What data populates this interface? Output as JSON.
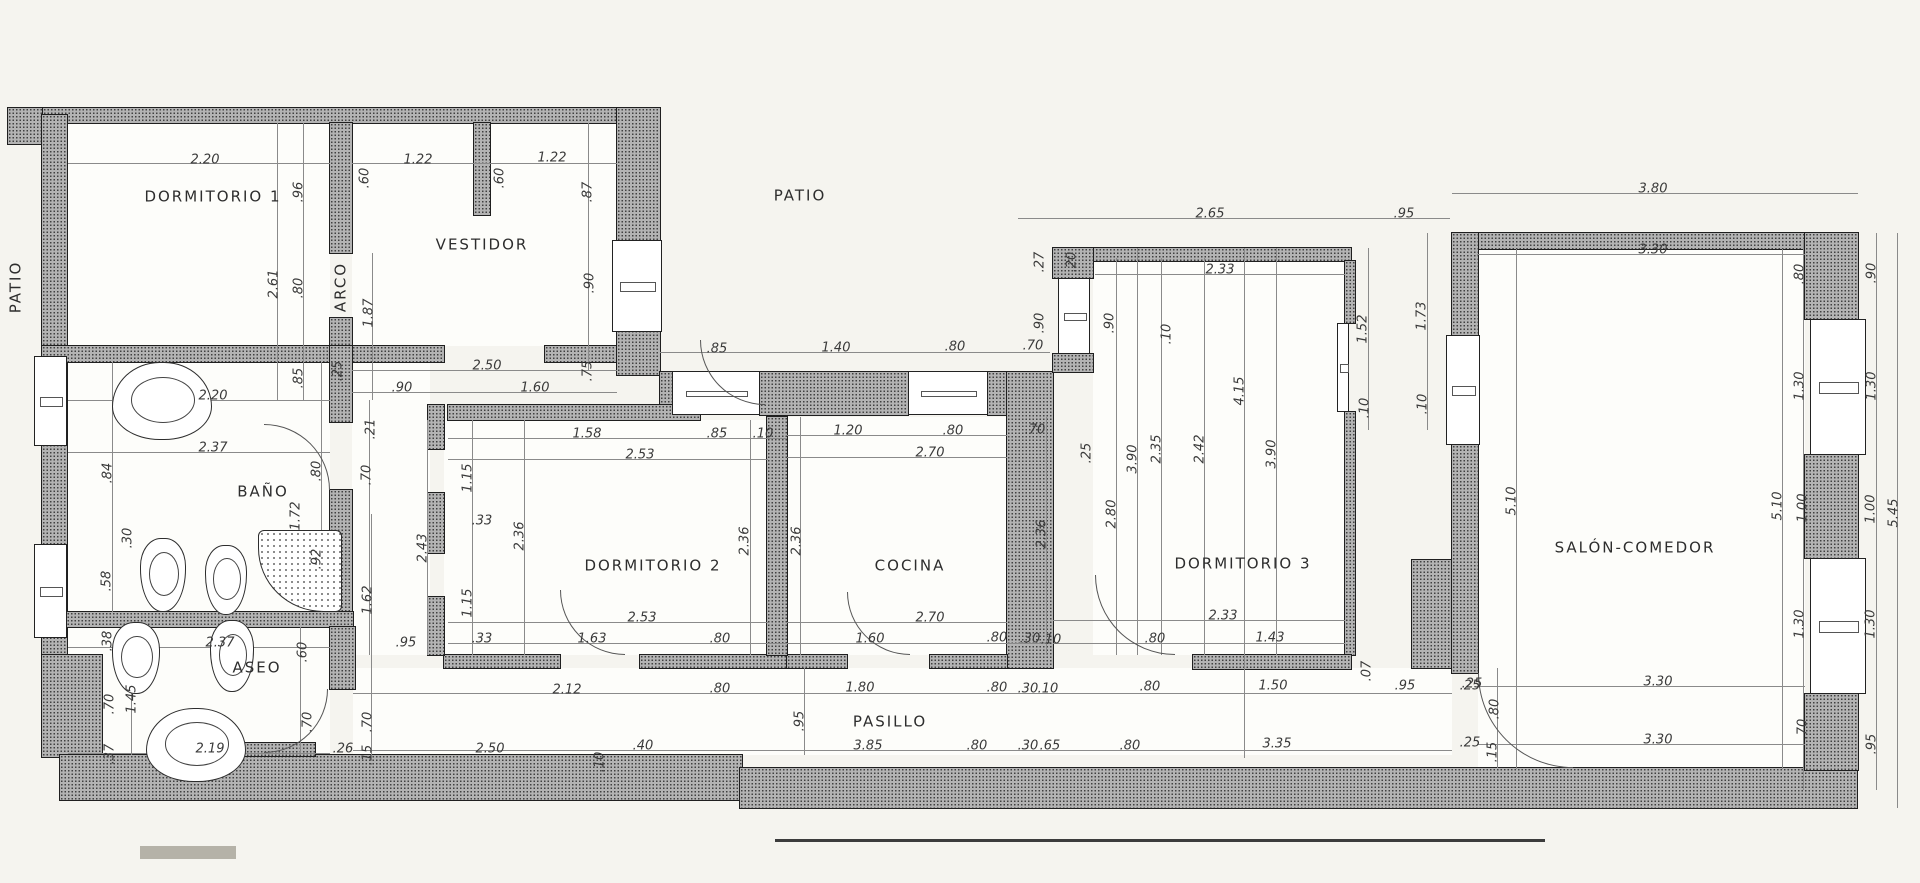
{
  "meta": {
    "type": "architectural-floor-plan",
    "language": "es",
    "units": "meters",
    "paper_color": "#f5f4ef",
    "wall_color": "#b3b3b3",
    "line_color": "#8a8a8a",
    "text_color": "#3a3a3a"
  },
  "plan": {
    "labels": [
      [
        "DORMITORIO 1",
        213,
        197,
        0
      ],
      [
        "VESTIDOR",
        482,
        245,
        0
      ],
      [
        "PATIO",
        800,
        196,
        0
      ],
      [
        "PATIO",
        16,
        287,
        1
      ],
      [
        "ARCO",
        341,
        287,
        1
      ],
      [
        "BAÑO",
        263,
        492,
        0
      ],
      [
        "ASEO",
        257,
        668,
        0
      ],
      [
        "DORMITORIO 2",
        653,
        566,
        0
      ],
      [
        "COCINA",
        910,
        566,
        0
      ],
      [
        "DORMITORIO 3",
        1243,
        564,
        0
      ],
      [
        "SALÓN-COMEDOR",
        1635,
        548,
        0
      ],
      [
        "PASILLO",
        890,
        722,
        0
      ]
    ],
    "dims": [
      [
        "2.20",
        205,
        160,
        0
      ],
      [
        "1.22",
        418,
        160,
        0
      ],
      [
        "1.22",
        552,
        158,
        0
      ],
      [
        "2.65",
        1210,
        214,
        0
      ],
      [
        ".95",
        1404,
        214,
        0
      ],
      [
        "3.80",
        1653,
        189,
        0
      ],
      [
        "3.30",
        1653,
        250,
        0
      ],
      [
        "2.33",
        1220,
        270,
        0
      ],
      [
        ".60",
        365,
        178,
        1
      ],
      [
        ".60",
        500,
        178,
        1
      ],
      [
        ".87",
        588,
        192,
        1
      ],
      [
        ".96",
        299,
        192,
        1
      ],
      [
        "2.61",
        274,
        284,
        1
      ],
      [
        ".80",
        299,
        288,
        1
      ],
      [
        "1.87",
        369,
        313,
        1
      ],
      [
        ".90",
        590,
        283,
        1
      ],
      [
        ".85",
        299,
        378,
        1
      ],
      [
        ".25",
        338,
        371,
        1
      ],
      [
        "2.20",
        213,
        396,
        0
      ],
      [
        "2.50",
        487,
        366,
        0
      ],
      [
        ".90",
        402,
        388,
        0
      ],
      [
        "1.60",
        535,
        388,
        0
      ],
      [
        ".75",
        588,
        371,
        1
      ],
      [
        ".85",
        717,
        349,
        0
      ],
      [
        "1.40",
        836,
        348,
        0
      ],
      [
        ".80",
        955,
        347,
        0
      ],
      [
        ".70",
        1033,
        346,
        0
      ],
      [
        ".27",
        1040,
        262,
        1
      ],
      [
        ".20",
        1072,
        262,
        1
      ],
      [
        ".90",
        1040,
        323,
        1
      ],
      [
        ".90",
        1110,
        323,
        1
      ],
      [
        "1.52",
        1363,
        329,
        1
      ],
      [
        "1.73",
        1422,
        316,
        1
      ],
      [
        ".10",
        1365,
        408,
        1
      ],
      [
        ".10",
        1423,
        404,
        1
      ],
      [
        ".70",
        367,
        475,
        1
      ],
      [
        ".21",
        371,
        429,
        1
      ],
      [
        "1.58",
        587,
        434,
        0
      ],
      [
        ".85",
        717,
        434,
        0
      ],
      [
        ".10",
        763,
        434,
        0
      ],
      [
        "2.53",
        640,
        455,
        0
      ],
      [
        "1.20",
        848,
        431,
        0
      ],
      [
        ".80",
        953,
        431,
        0
      ],
      [
        ".70",
        1035,
        430,
        0
      ],
      [
        "2.70",
        930,
        453,
        0
      ],
      [
        ".25",
        1087,
        453,
        1
      ],
      [
        "1.15",
        468,
        478,
        1
      ],
      [
        ".33",
        482,
        521,
        0
      ],
      [
        "2.36",
        520,
        536,
        1
      ],
      [
        "2.43",
        423,
        548,
        1
      ],
      [
        "2.36",
        745,
        541,
        1
      ],
      [
        "2.36",
        797,
        541,
        1
      ],
      [
        "2.36",
        1042,
        534,
        1
      ],
      [
        "2.80",
        1112,
        514,
        1
      ],
      [
        "3.90",
        1133,
        459,
        1
      ],
      [
        "2.35",
        1157,
        449,
        1
      ],
      [
        "2.42",
        1200,
        449,
        1
      ],
      [
        "3.90",
        1272,
        454,
        1
      ],
      [
        ".10",
        1167,
        334,
        1
      ],
      [
        "4.15",
        1240,
        391,
        1
      ],
      [
        "5.10",
        1512,
        501,
        1
      ],
      [
        "5.10",
        1778,
        506,
        1
      ],
      [
        "1.15",
        468,
        603,
        1
      ],
      [
        ".33",
        482,
        639,
        0
      ],
      [
        "2.53",
        642,
        618,
        0
      ],
      [
        "1.63",
        592,
        639,
        0
      ],
      [
        ".80",
        720,
        639,
        0
      ],
      [
        "2.70",
        930,
        618,
        0
      ],
      [
        "1.60",
        870,
        639,
        0
      ],
      [
        ".80",
        997,
        638,
        0
      ],
      [
        ".30",
        1030,
        639,
        0
      ],
      [
        ".10",
        1051,
        640,
        0
      ],
      [
        "2.33",
        1223,
        616,
        0
      ],
      [
        "1.43",
        1270,
        638,
        0
      ],
      [
        ".80",
        1155,
        639,
        0
      ],
      [
        "2.12",
        567,
        690,
        0
      ],
      [
        ".80",
        720,
        689,
        0
      ],
      [
        "1.80",
        860,
        688,
        0
      ],
      [
        ".80",
        997,
        688,
        0
      ],
      [
        ".30",
        1028,
        689,
        0
      ],
      [
        ".10",
        1048,
        689,
        0
      ],
      [
        ".80",
        1150,
        687,
        0
      ],
      [
        "1.50",
        1273,
        686,
        0
      ],
      [
        ".95",
        1405,
        686,
        0
      ],
      [
        ".25",
        1470,
        686,
        0
      ],
      [
        ".07",
        1367,
        671,
        1
      ],
      [
        ".80",
        1495,
        709,
        1
      ],
      [
        "2.50",
        490,
        749,
        0
      ],
      [
        ".40",
        643,
        746,
        0
      ],
      [
        ".10",
        600,
        762,
        1
      ],
      [
        "3.85",
        868,
        746,
        0
      ],
      [
        ".95",
        800,
        721,
        1
      ],
      [
        ".80",
        977,
        746,
        0
      ],
      [
        ".30",
        1028,
        746,
        0
      ],
      [
        ".65",
        1050,
        746,
        0
      ],
      [
        ".80",
        1130,
        746,
        0
      ],
      [
        "3.35",
        1277,
        744,
        0
      ],
      [
        ".25",
        1470,
        743,
        0
      ],
      [
        ".15",
        1493,
        752,
        1
      ],
      [
        ".26",
        343,
        749,
        0
      ],
      [
        ".15",
        368,
        755,
        1
      ],
      [
        "3.30",
        1658,
        682,
        0
      ],
      [
        "3.30",
        1658,
        740,
        0
      ],
      [
        ".25",
        1472,
        684,
        0
      ],
      [
        ".80",
        1800,
        274,
        1
      ],
      [
        ".90",
        1872,
        273,
        1
      ],
      [
        "1.30",
        1800,
        386,
        1
      ],
      [
        "1.30",
        1872,
        386,
        1
      ],
      [
        "1.00",
        1803,
        508,
        1
      ],
      [
        "1.00",
        1871,
        509,
        1
      ],
      [
        "5.45",
        1894,
        513,
        1
      ],
      [
        "1.30",
        1800,
        624,
        1
      ],
      [
        "1.30",
        1871,
        624,
        1
      ],
      [
        ".70",
        1803,
        729,
        1
      ],
      [
        ".95",
        1872,
        744,
        1
      ],
      [
        "2.37",
        213,
        448,
        0
      ],
      [
        ".84",
        108,
        473,
        1
      ],
      [
        ".30",
        128,
        538,
        1
      ],
      [
        ".58",
        107,
        581,
        1
      ],
      [
        ".80",
        317,
        471,
        1
      ],
      [
        "1.72",
        296,
        516,
        1
      ],
      [
        ".92",
        317,
        559,
        1
      ],
      [
        "1.62",
        368,
        600,
        1
      ],
      [
        "2.37",
        220,
        643,
        0
      ],
      [
        "2.19",
        210,
        749,
        0
      ],
      [
        ".38",
        108,
        641,
        1
      ],
      [
        "1.45",
        132,
        699,
        1
      ],
      [
        ".70",
        110,
        704,
        1
      ],
      [
        ".37",
        110,
        754,
        1
      ],
      [
        ".60",
        303,
        652,
        1
      ],
      [
        ".70",
        308,
        722,
        1
      ],
      [
        ".70",
        368,
        722,
        1
      ],
      [
        ".95",
        406,
        643,
        0
      ]
    ],
    "roomfills": [
      [
        67,
        123,
        263,
        223
      ],
      [
        352,
        123,
        265,
        223
      ],
      [
        67,
        362,
        263,
        250
      ],
      [
        67,
        627,
        263,
        128
      ],
      [
        352,
        362,
        78,
        293
      ],
      [
        444,
        420,
        323,
        235
      ],
      [
        787,
        417,
        220,
        238
      ],
      [
        1093,
        261,
        252,
        394
      ],
      [
        1478,
        249,
        327,
        519
      ],
      [
        353,
        668,
        1099,
        87
      ]
    ],
    "walls": [
      [
        8,
        108,
        652,
        15
      ],
      [
        8,
        108,
        34,
        36
      ],
      [
        42,
        115,
        25,
        543
      ],
      [
        330,
        123,
        22,
        130
      ],
      [
        330,
        318,
        22,
        28
      ],
      [
        42,
        346,
        311,
        16
      ],
      [
        352,
        346,
        92,
        16
      ],
      [
        545,
        346,
        72,
        16
      ],
      [
        474,
        123,
        16,
        92
      ],
      [
        617,
        108,
        43,
        134
      ],
      [
        617,
        330,
        43,
        45
      ],
      [
        660,
        372,
        14,
        43
      ],
      [
        760,
        372,
        148,
        43
      ],
      [
        988,
        372,
        20,
        43
      ],
      [
        1007,
        372,
        46,
        296
      ],
      [
        1053,
        248,
        298,
        13
      ],
      [
        1053,
        248,
        40,
        30
      ],
      [
        1053,
        354,
        40,
        18
      ],
      [
        1345,
        261,
        10,
        62
      ],
      [
        1345,
        412,
        10,
        243
      ],
      [
        1193,
        655,
        158,
        14
      ],
      [
        444,
        655,
        116,
        13
      ],
      [
        640,
        655,
        147,
        13
      ],
      [
        787,
        655,
        60,
        13
      ],
      [
        930,
        655,
        77,
        13
      ],
      [
        767,
        417,
        20,
        238
      ],
      [
        448,
        405,
        252,
        15
      ],
      [
        428,
        405,
        16,
        44
      ],
      [
        428,
        493,
        16,
        60
      ],
      [
        428,
        597,
        16,
        58
      ],
      [
        330,
        346,
        22,
        76
      ],
      [
        330,
        490,
        22,
        122
      ],
      [
        42,
        612,
        311,
        15
      ],
      [
        330,
        627,
        25,
        62
      ],
      [
        42,
        655,
        60,
        102
      ],
      [
        60,
        755,
        682,
        45
      ],
      [
        740,
        768,
        1117,
        40
      ],
      [
        183,
        743,
        132,
        13
      ],
      [
        1412,
        560,
        40,
        108
      ],
      [
        1452,
        233,
        403,
        16
      ],
      [
        1452,
        233,
        26,
        102
      ],
      [
        1452,
        445,
        26,
        228
      ],
      [
        1805,
        233,
        53,
        86
      ],
      [
        1805,
        455,
        53,
        103
      ],
      [
        1805,
        694,
        53,
        76
      ]
    ],
    "windows": [
      [
        34,
        356,
        33,
        90
      ],
      [
        34,
        544,
        33,
        94
      ],
      [
        612,
        240,
        50,
        92
      ],
      [
        672,
        371,
        88,
        44
      ],
      [
        908,
        371,
        80,
        44
      ],
      [
        1058,
        278,
        32,
        76
      ],
      [
        1337,
        323,
        12,
        89
      ],
      [
        1446,
        335,
        34,
        110
      ],
      [
        1810,
        319,
        56,
        136
      ],
      [
        1810,
        558,
        56,
        136
      ]
    ],
    "lines": [
      [
        68,
        163,
        262,
        1
      ],
      [
        352,
        163,
        265,
        1
      ],
      [
        1018,
        218,
        432,
        1
      ],
      [
        1452,
        193,
        406,
        1
      ],
      [
        1477,
        254,
        328,
        1
      ],
      [
        1095,
        274,
        250,
        1
      ],
      [
        660,
        352,
        390,
        1
      ],
      [
        68,
        400,
        262,
        1
      ],
      [
        352,
        370,
        265,
        1
      ],
      [
        352,
        392,
        265,
        1
      ],
      [
        448,
        438,
        339,
        1
      ],
      [
        448,
        459,
        320,
        1
      ],
      [
        787,
        435,
        220,
        1
      ],
      [
        787,
        457,
        220,
        1
      ],
      [
        448,
        622,
        320,
        1
      ],
      [
        448,
        643,
        339,
        1
      ],
      [
        787,
        622,
        220,
        1
      ],
      [
        787,
        643,
        260,
        1
      ],
      [
        1053,
        620,
        292,
        1
      ],
      [
        1053,
        643,
        292,
        1
      ],
      [
        353,
        693,
        1099,
        1
      ],
      [
        353,
        750,
        1099,
        1
      ],
      [
        1477,
        686,
        328,
        1
      ],
      [
        1477,
        744,
        328,
        1
      ],
      [
        68,
        452,
        262,
        1
      ],
      [
        68,
        647,
        262,
        1
      ],
      [
        68,
        753,
        262,
        1
      ],
      [
        303,
        123,
        1,
        277
      ],
      [
        277,
        123,
        1,
        277
      ],
      [
        372,
        253,
        1,
        147
      ],
      [
        588,
        123,
        1,
        247
      ],
      [
        369,
        400,
        1,
        255
      ],
      [
        472,
        420,
        1,
        235
      ],
      [
        524,
        420,
        1,
        235
      ],
      [
        427,
        420,
        1,
        235
      ],
      [
        750,
        420,
        1,
        235
      ],
      [
        800,
        417,
        1,
        238
      ],
      [
        1046,
        417,
        1,
        238
      ],
      [
        1116,
        258,
        1,
        397
      ],
      [
        1137,
        248,
        1,
        407
      ],
      [
        1161,
        258,
        1,
        397
      ],
      [
        1204,
        258,
        1,
        397
      ],
      [
        1244,
        248,
        1,
        510
      ],
      [
        1276,
        248,
        1,
        407
      ],
      [
        1368,
        248,
        1,
        182
      ],
      [
        1427,
        233,
        1,
        197
      ],
      [
        1516,
        249,
        1,
        520
      ],
      [
        1782,
        249,
        1,
        520
      ],
      [
        1803,
        240,
        1,
        550
      ],
      [
        1876,
        233,
        1,
        557
      ],
      [
        1897,
        233,
        1,
        575
      ],
      [
        112,
        362,
        1,
        250
      ],
      [
        131,
        627,
        1,
        128
      ],
      [
        321,
        362,
        1,
        250
      ],
      [
        300,
        627,
        1,
        128
      ],
      [
        371,
        514,
        1,
        241
      ],
      [
        804,
        668,
        1,
        87
      ],
      [
        1497,
        668,
        1,
        100
      ]
    ],
    "marks": [
      [
        775,
        839,
        770,
        3,
        "#3c3c3c"
      ],
      [
        140,
        846,
        96,
        13,
        "#b5b2a8"
      ]
    ],
    "doors": [
      [
        264,
        424,
        66,
        "tr"
      ],
      [
        264,
        689,
        64,
        "br"
      ],
      [
        700,
        340,
        65,
        "bl"
      ],
      [
        560,
        590,
        65,
        "bl"
      ],
      [
        847,
        592,
        63,
        "bl"
      ],
      [
        1095,
        575,
        80,
        "bl"
      ],
      [
        1478,
        673,
        95,
        "bl"
      ]
    ],
    "fixtures": [
      [
        "sink",
        112,
        362,
        100,
        78
      ],
      [
        "toilet",
        140,
        538,
        46,
        74
      ],
      [
        "bidet",
        205,
        545,
        42,
        70
      ],
      [
        "shower",
        258,
        530,
        84,
        82
      ],
      [
        "toilet",
        112,
        622,
        48,
        72
      ],
      [
        "bidet",
        210,
        620,
        44,
        72
      ],
      [
        "sink",
        146,
        708,
        100,
        74
      ]
    ]
  }
}
